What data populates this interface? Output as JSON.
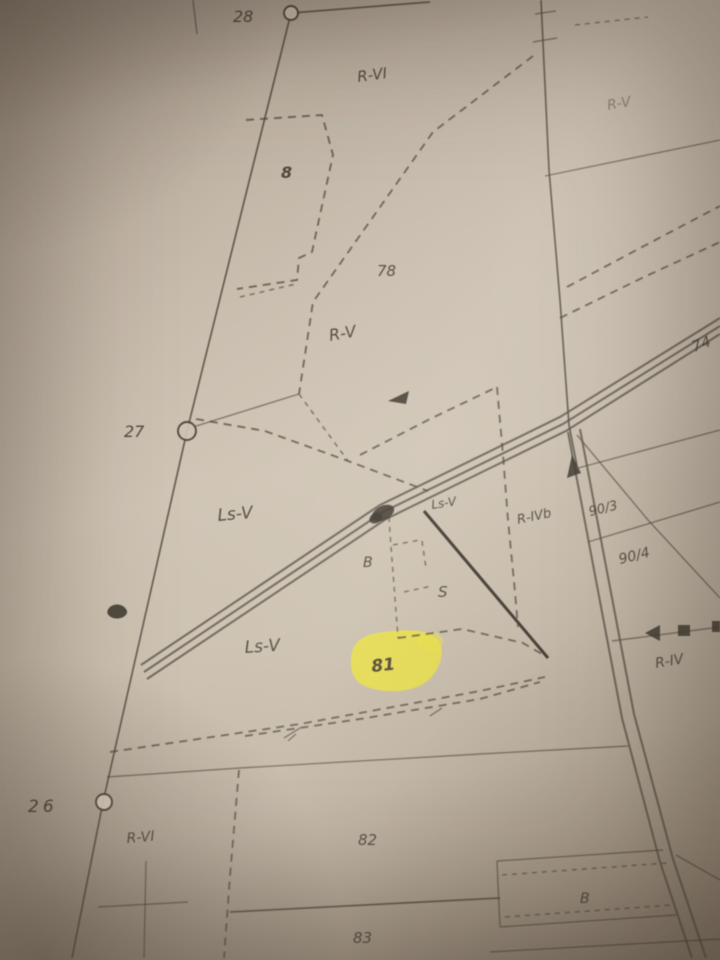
{
  "map_labels": {
    "point_28": "28",
    "point_27": "27",
    "point_26": "26",
    "zone_top": "R-VI",
    "zone_top_right": "R-V",
    "parcel_8": "8",
    "parcel_78": "78",
    "zone_center": "R-V",
    "zone_ls_upper": "Ls-V",
    "zone_ls_small": "Ls-V",
    "zone_r_ivb": "R-IVb",
    "parcel_90_3": "90/3",
    "parcel_90_4": "90/4",
    "zone_r_iv": "R-IV",
    "parcel_74": "74",
    "building_mid": "B",
    "orchard_s": "S",
    "zone_ls_lower": "Ls-V",
    "parcel_81": "81",
    "zone_bottom_left": "R-VI",
    "parcel_82": "82",
    "parcel_83": "83",
    "building_bottom": "B"
  },
  "highlight": {
    "parcel": "81",
    "color": "#ece23b"
  },
  "colors": {
    "paper": "#cbc0af",
    "ink": "#3d362c",
    "highlight": "#ece23b"
  }
}
